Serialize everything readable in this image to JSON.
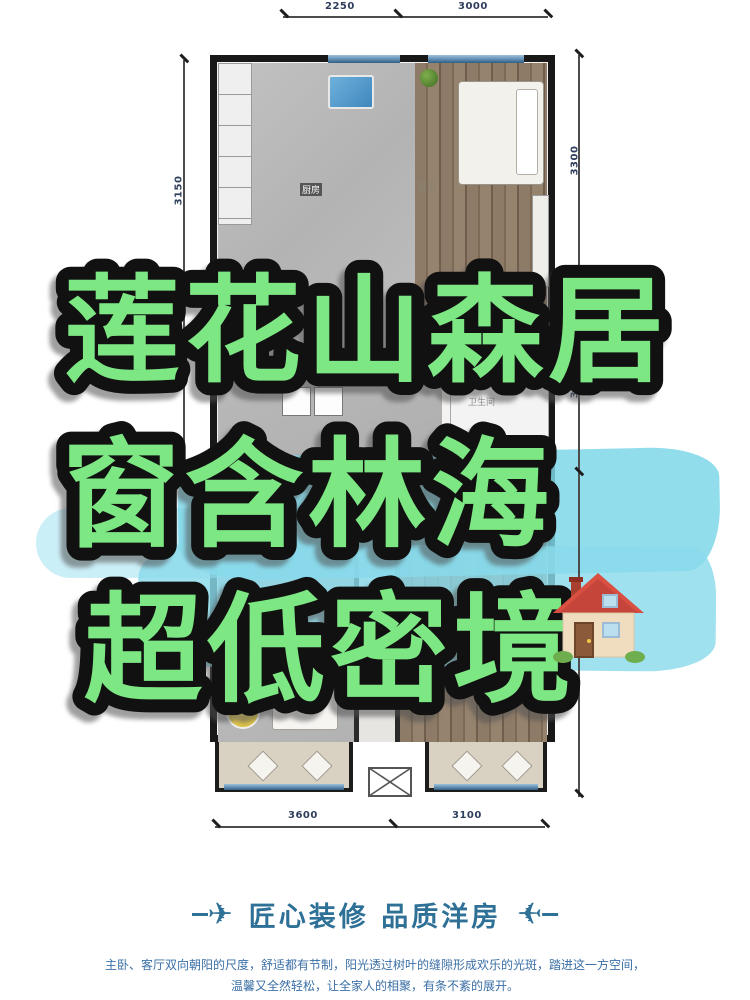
{
  "floor_plan": {
    "room_labels": {
      "kitchen": "厨房",
      "bedroom": "卧室",
      "bathroom": "卫生间"
    },
    "dimensions": {
      "top_left": "2250",
      "top_right": "3000",
      "left": "3150",
      "right_upper": "3300",
      "right_lower": "3100",
      "bottom_left": "3600",
      "bottom_right": "3100"
    }
  },
  "overlay": {
    "title_line1": "莲花山森居",
    "title_line2": "窗含林海",
    "title_line3": "超低密境",
    "house_emoji": "🏠",
    "title_color": "#7de783",
    "outline_color": "#111111",
    "brush_color": "#7ed7e9"
  },
  "footer": {
    "plane_icon": "✈",
    "tagline": "匠心装修 品质洋房",
    "tagline_color": "#2e7096",
    "paragraph_line1": "主卧、客厅双向朝阳的尺度，舒适都有节制，阳光透过树叶的缝隙形成欢乐的光斑，踏进这一方空间，",
    "paragraph_line2": "温馨又全然轻松，让全家人的相聚，有条不紊的展开。"
  }
}
